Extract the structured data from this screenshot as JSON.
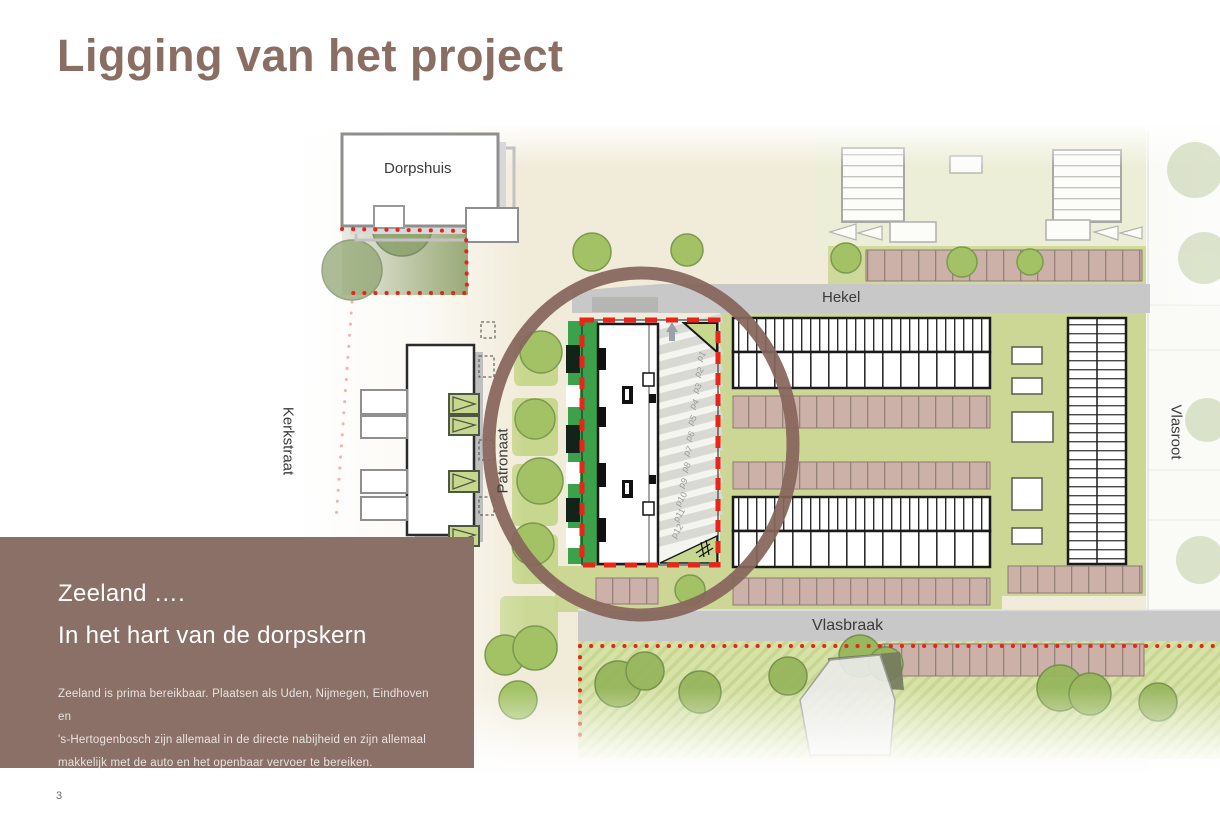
{
  "slide": {
    "title": "Ligging van het project",
    "page_number": "3"
  },
  "overlay": {
    "heading_line1": "Zeeland ….",
    "heading_line2": "In het hart van de dorpskern",
    "body": "Zeeland is prima bereikbaar. Plaatsen als Uden, Nijmegen, Eindhoven en\n's-Hertogenbosch zijn allemaal in de directe nabijheid en zijn allemaal\nmakkelijk met de auto en het openbaar vervoer te bereiken."
  },
  "map": {
    "street_labels": {
      "dorpshuis": "Dorpshuis",
      "hekel": "Hekel",
      "kerkstraat": "Kerkstraat",
      "patronaat": "Patronaat",
      "vlasroot": "Vlasroot",
      "vlasbraak": "Vlasbraak"
    },
    "parking_labels": [
      "p1",
      "p2",
      "p3",
      "p4",
      "p5",
      "p6",
      "p7",
      "p8",
      "p9",
      "p10",
      "p11",
      "p12"
    ]
  },
  "colors": {
    "title_brown": "#8a6e63",
    "overlay_brown": "#8a7066",
    "circle_brown": "#87655b",
    "map_beige": "#f1ebd9",
    "green_light": "#ccd795",
    "green_bright": "#3ca14b",
    "pink_strip": "#ccb1a9",
    "road_gray": "#c8c8c8",
    "boundary_red": "#e8231a"
  }
}
